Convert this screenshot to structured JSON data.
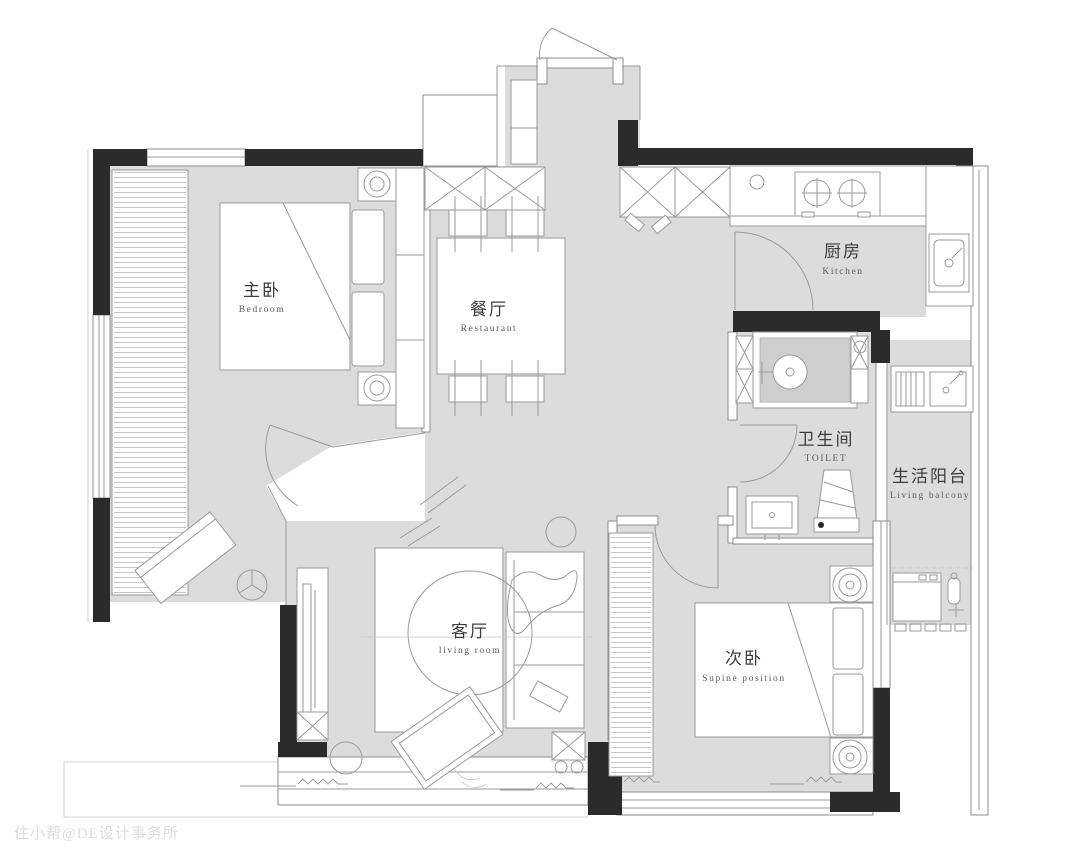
{
  "page": {
    "type": "apartment-floor-plan"
  },
  "colors": {
    "floor": "#dcdcdc",
    "shower_floor": "#cfcfcf",
    "wall": "#2b2b2b",
    "line": "#9a9a9a",
    "label_zh": "#3c3c3c",
    "label_en": "#5a5a5a",
    "watermark": "#dcdcdc"
  },
  "rooms": [
    {
      "id": "master-bedroom",
      "zh": "主卧",
      "en": "Bedroom"
    },
    {
      "id": "dining-room",
      "zh": "餐厅",
      "en": "Restaurant"
    },
    {
      "id": "kitchen",
      "zh": "厨房",
      "en": "Kitchen"
    },
    {
      "id": "toilet",
      "zh": "卫生间",
      "en": "TOILET"
    },
    {
      "id": "living-balcony",
      "zh": "生活阳台",
      "en": "Living balcony"
    },
    {
      "id": "living-room",
      "zh": "客厅",
      "en": "living room"
    },
    {
      "id": "second-bedroom",
      "zh": "次卧",
      "en": "Supine position"
    }
  ],
  "watermark": "住小帮@DE设计事务所"
}
